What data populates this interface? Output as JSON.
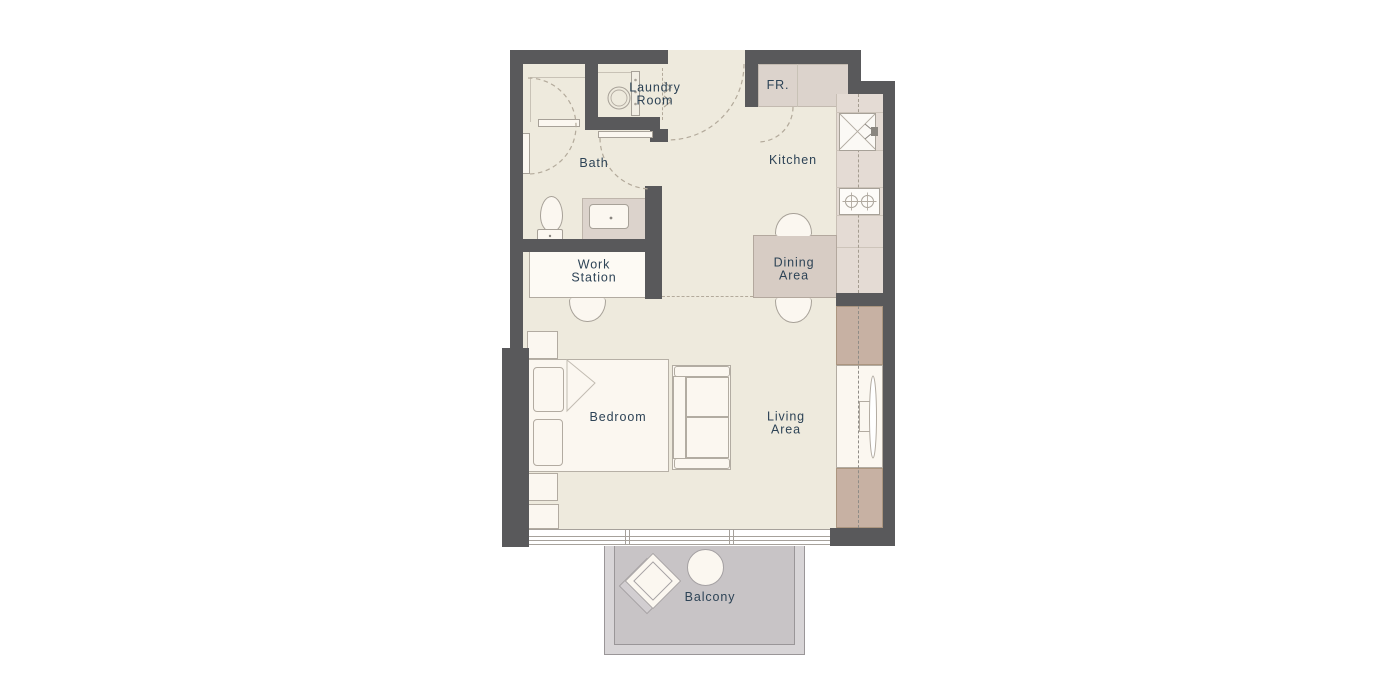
{
  "page": {
    "background": "#ffffff",
    "type": "apartment-floor-plan"
  },
  "labels": {
    "laundry": "Laundry\nRoom",
    "fridge": "FR.",
    "bath": "Bath",
    "kitchen": "Kitchen",
    "workstation": "Work\nStation",
    "dining": "Dining\nArea",
    "bedroom": "Bedroom",
    "living": "Living\nArea",
    "balcony": "Balcony"
  },
  "colors": {
    "wall": "#59595b",
    "floor": "#eeeadd",
    "counter": "#e4dbd4",
    "surface": "#dcd3cc",
    "table": "#d7ccc4",
    "cabinet": "#c7b1a3",
    "furniture": "#fbf7f0",
    "outline": "#b2aba1",
    "fixture_line": "#a7a198",
    "balcony_floor": "#c8c4c6",
    "balcony_band": "#d8d5d7",
    "balcony_line": "#9a9698",
    "ink": "#2d4356",
    "dash": "#b3aa9b",
    "window_line": "#a6a19b"
  },
  "icons": {
    "washing-machine-icon": "circle-drum",
    "kitchen-sink-icon": "basin-with-cross",
    "stove-icon": "two-burners",
    "toilet-icon": "bowl-and-tank",
    "bathroom-sink-icon": "inset-basin",
    "shower-door-icon": "bar-with-arc",
    "tv-icon": "screen-lens",
    "bed-icon": "bed-with-pillows",
    "sofa-icon": "sofa-cushions",
    "dining-table-icon": "rectangle",
    "chair-icon": "half-round-arch",
    "balcony-chair-icon": "diamond-seat",
    "balcony-table-icon": "round-table",
    "door-swing-icon": "dashed-quarter-arc",
    "window-icon": "triple-line-strip"
  }
}
